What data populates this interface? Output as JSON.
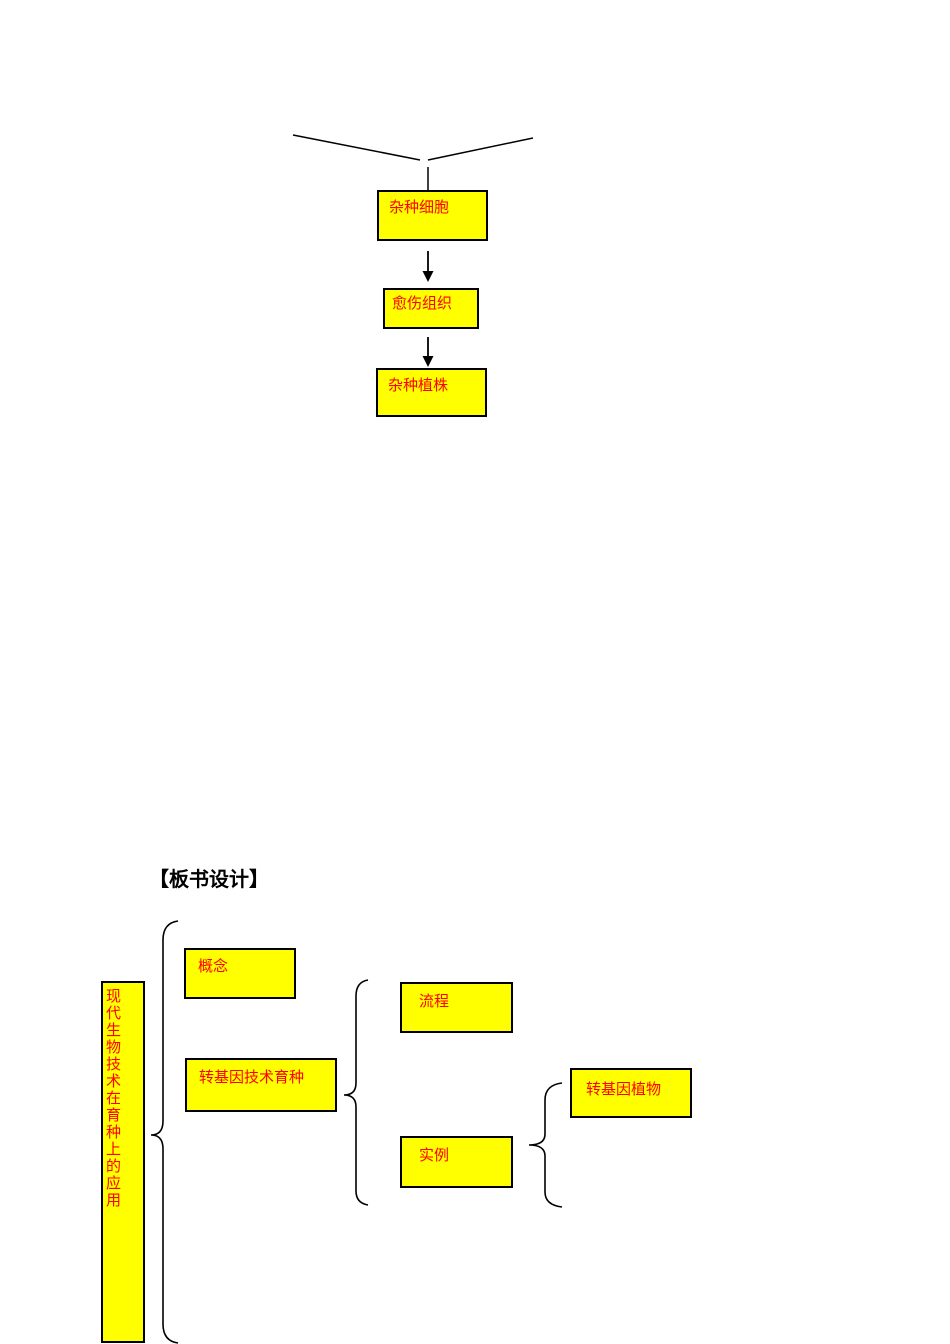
{
  "colors": {
    "box_fill": "#ffff00",
    "box_border": "#000000",
    "box_text": "#ff0000",
    "line": "#000000",
    "heading_text": "#000000"
  },
  "flowchart_top": {
    "nodes": [
      {
        "id": "hybrid-cell",
        "label": "杂种细胞"
      },
      {
        "id": "callus",
        "label": "愈伤组织"
      },
      {
        "id": "hybrid-plant",
        "label": "杂种植株"
      }
    ],
    "connectors": [
      "merge-v-lines",
      "down-arrow",
      "down-arrow"
    ]
  },
  "heading": {
    "text": "【板书设计】"
  },
  "board_design": {
    "root": {
      "label": "现代生物技术在育种上的应用"
    },
    "branches": {
      "concept": {
        "label": "概念"
      },
      "transgenic_breeding": {
        "label": "转基因技术育种"
      },
      "process": {
        "label": "流程"
      },
      "example": {
        "label": "实例"
      },
      "transgenic_plant": {
        "label": "转基因植物"
      }
    }
  }
}
